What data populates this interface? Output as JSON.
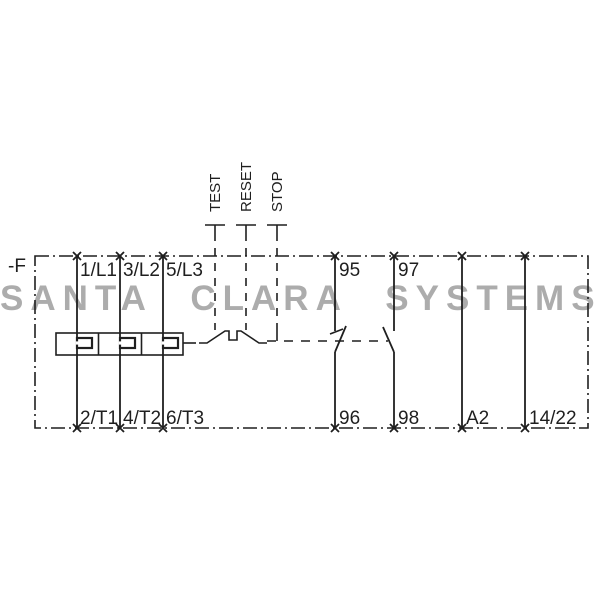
{
  "watermark": {
    "text": "SANTA CLARA SYSTEMS"
  },
  "schematic": {
    "device_label": "-F",
    "controls": [
      {
        "label": "TEST"
      },
      {
        "label": "RESET"
      },
      {
        "label": "STOP"
      }
    ],
    "terminals": {
      "top": [
        "1/L1",
        "3/L2",
        "5/L3",
        "95",
        "97"
      ],
      "bottom": [
        "2/T1",
        "4/T2",
        "6/T3",
        "96",
        "98",
        "A2",
        "14/22"
      ]
    },
    "components": [
      "thermal-overload-heater-elements",
      "trip-mechanism",
      "nc-contact-95-96",
      "no-contact-97-98"
    ]
  },
  "colors": {
    "line": "#1f1f1f",
    "watermark": "#acacac",
    "background": "#ffffff"
  }
}
